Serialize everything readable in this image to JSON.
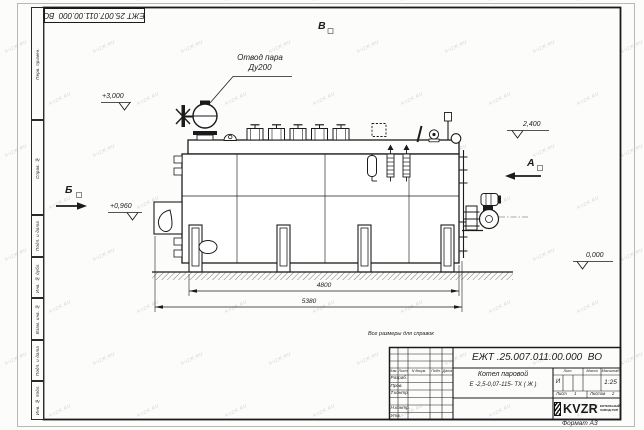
{
  "watermark": {
    "text": "KVZR.RU"
  },
  "frame": {
    "corner_stamp": "ЕЖТ 25.007.011.00.000  ВО",
    "margin_fields": [
      "Перв. примен.",
      "Справ. №",
      "Подп. и дата",
      "Инв. № дубл.",
      "Взам. инв. №",
      "Подп. и дата",
      "Инв. № подл."
    ],
    "format_label": "Формат А3"
  },
  "annotations": {
    "callout_line1": "Отвод пара",
    "callout_line2": "Ду200",
    "elev_roof": "+3,000",
    "elev_burner": "+0,960",
    "elev_top": "2,400",
    "elev_ground": "0,000",
    "view_b": "Б",
    "view_v": "В",
    "view_a": "А",
    "dim_inner": "4800",
    "dim_overall": "5380"
  },
  "title_block": {
    "note": "Все размеры для справок",
    "doc_number": "ЕЖТ .25.007.011.00.000  ВО",
    "product_line1": "Котел паровой",
    "product_line2": "Е -2,5-0,07-115- ТХ ( Ж )",
    "header_cols": [
      "Изм.",
      "Лист",
      "N докум.",
      "Подп.",
      "Дата"
    ],
    "row_labels": [
      "Разраб.",
      "Пров.",
      "Т.контр.",
      "Н.контр.",
      "Утв."
    ],
    "lit_label": "Лит.",
    "lit_value": "И",
    "mass_label": "Масса",
    "scale_label": "Масштаб",
    "scale_value": "1:25",
    "sheet_label": "Лист",
    "sheet_value": "1",
    "sheets_label": "Листов",
    "sheets_value": "2",
    "logo_text": "KVZR",
    "logo_sub1": "КОТЕЛЬНЫЙ",
    "logo_sub2": "ЗАВОД РЭП"
  }
}
